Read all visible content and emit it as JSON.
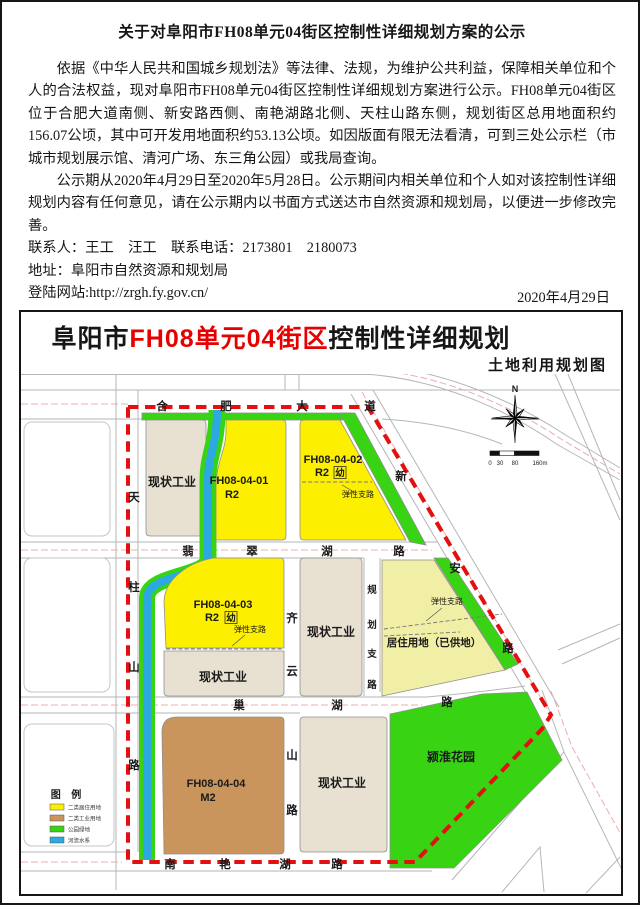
{
  "notice": {
    "title": "关于对阜阳市FH08单元04街区控制性详细规划方案的公示",
    "para1": "依据《中华人民共和国城乡规划法》等法律、法规，为维护公共利益，保障相关单位和个人的合法权益，现对阜阳市FH08单元04街区控制性详细规划方案进行公示。FH08单元04街区位于合肥大道南侧、新安路西侧、南艳湖路北侧、天柱山路东侧，规划街区总用地面积约156.07公顷，其中可开发用地面积约53.13公顷。如因版面有限无法看清，可到三处公示栏（市城市规划展示馆、清河广场、东三角公园）或我局查询。",
    "para2": "公示期从2020年4月29日至2020年5月28日。公示期间内相关单位和个人如对该控制性详细规划内容有任何意见，请在公示期内以书面方式送达市自然资源和规划局，以便进一步修改完善。",
    "contact": "联系人：王工　汪工　联系电话：2173801　2180073",
    "address": "地址：阜阳市自然资源和规划局",
    "website": "登陆网站:http://zrgh.fy.gov.cn/",
    "date": "2020年4月29日"
  },
  "map": {
    "title": {
      "prefix": "阜阳市",
      "highlight": "FH08单元04街区",
      "suffix": "控制性详细规划"
    },
    "subtitle": "土地利用规划图",
    "compass_label": "N",
    "colors": {
      "r2": "#FCEF00",
      "m2": "#C9955C",
      "existing": "#E8E1D2",
      "supplied": "#F1EFA6",
      "green": "#38D413",
      "water": "#2BA9E0",
      "boundary": "#E41010",
      "highlight_red": "#E60000"
    },
    "legend": {
      "title": "图 例",
      "items": [
        {
          "label": "二类居住用地",
          "color": "#FCEF00"
        },
        {
          "label": "二类工业用地",
          "color": "#C9955C"
        },
        {
          "label": "公园绿地",
          "color": "#38D413"
        },
        {
          "label": "河流水系",
          "color": "#2BA9E0"
        }
      ]
    },
    "scale": {
      "segments": [
        {
          "x": 488,
          "w": 9.5,
          "fill": "#111111"
        },
        {
          "x": 497.5,
          "w": 15,
          "fill": "#ffffff"
        },
        {
          "x": 512.5,
          "w": 24.5,
          "fill": "#111111"
        }
      ],
      "labels": [
        {
          "t": "0",
          "x": 488
        },
        {
          "t": "30",
          "x": 498
        },
        {
          "t": "80",
          "x": 513
        },
        {
          "t": "160m",
          "x": 538
        }
      ]
    },
    "labels": [
      {
        "t": "合",
        "x": 160,
        "y": 408,
        "c": "road",
        "n": "road-label-hefei-avenue"
      },
      {
        "t": "肥",
        "x": 224,
        "y": 408,
        "c": "road",
        "n": "road-label-hefei-avenue"
      },
      {
        "t": "大",
        "x": 300,
        "y": 408,
        "c": "road",
        "n": "road-label-hefei-avenue"
      },
      {
        "t": "道",
        "x": 368,
        "y": 408,
        "c": "road",
        "n": "road-label-hefei-avenue"
      },
      {
        "t": "翡",
        "x": 186,
        "y": 553,
        "c": "road",
        "n": "road-label-feicuihu-road"
      },
      {
        "t": "翠",
        "x": 250,
        "y": 553,
        "c": "road",
        "n": "road-label-feicuihu-road"
      },
      {
        "t": "湖",
        "x": 325,
        "y": 553,
        "c": "road",
        "n": "road-label-feicuihu-road"
      },
      {
        "t": "路",
        "x": 397,
        "y": 553,
        "c": "road",
        "n": "road-label-feicuihu-road"
      },
      {
        "t": "巢",
        "x": 237,
        "y": 707,
        "c": "road",
        "n": "road-label-chaohu-road"
      },
      {
        "t": "湖",
        "x": 335,
        "y": 707,
        "c": "road",
        "n": "road-label-chaohu-road"
      },
      {
        "t": "路",
        "x": 445,
        "y": 704,
        "c": "road",
        "n": "road-label-chaohu-road"
      },
      {
        "t": "南",
        "x": 168,
        "y": 866,
        "c": "road",
        "n": "road-label-nanyanhu-road"
      },
      {
        "t": "艳",
        "x": 223,
        "y": 866,
        "c": "road",
        "n": "road-label-nanyanhu-road"
      },
      {
        "t": "湖",
        "x": 283,
        "y": 866,
        "c": "road",
        "n": "road-label-nanyanhu-road"
      },
      {
        "t": "路",
        "x": 335,
        "y": 866,
        "c": "road",
        "n": "road-label-nanyanhu-road"
      },
      {
        "t": "天",
        "x": 132,
        "y": 499,
        "c": "road",
        "n": "road-label-tianzhushan-road"
      },
      {
        "t": "柱",
        "x": 132,
        "y": 589,
        "c": "road",
        "n": "road-label-tianzhushan-road"
      },
      {
        "t": "山",
        "x": 132,
        "y": 669,
        "c": "road",
        "n": "road-label-tianzhushan-road"
      },
      {
        "t": "路",
        "x": 132,
        "y": 767,
        "c": "road",
        "n": "road-label-tianzhushan-road"
      },
      {
        "t": "齐",
        "x": 290,
        "y": 620,
        "c": "road",
        "n": "road-label-qiyunshan-road"
      },
      {
        "t": "云",
        "x": 290,
        "y": 673,
        "c": "road",
        "n": "road-label-qiyunshan-road"
      },
      {
        "t": "山",
        "x": 290,
        "y": 757,
        "c": "road",
        "n": "road-label-qiyunshan-road"
      },
      {
        "t": "路",
        "x": 290,
        "y": 812,
        "c": "road",
        "n": "road-label-qiyunshan-road"
      },
      {
        "t": "规",
        "x": 370,
        "y": 591,
        "c": "roadsm",
        "n": "road-label-planned-branch-road"
      },
      {
        "t": "划",
        "x": 370,
        "y": 626,
        "c": "roadsm",
        "n": "road-label-planned-branch-road"
      },
      {
        "t": "支",
        "x": 370,
        "y": 655,
        "c": "roadsm",
        "n": "road-label-planned-branch-road"
      },
      {
        "t": "路",
        "x": 370,
        "y": 686,
        "c": "roadsm",
        "n": "road-label-planned-branch-road"
      },
      {
        "t": "新",
        "x": 399,
        "y": 478,
        "c": "road",
        "n": "road-label-xinan-road"
      },
      {
        "t": "安",
        "x": 453,
        "y": 570,
        "c": "road",
        "n": "road-label-xinan-road"
      },
      {
        "t": "路",
        "x": 506,
        "y": 650,
        "c": "road",
        "n": "road-label-xinan-road"
      },
      {
        "t": "FH08-04-01",
        "x": 237,
        "y": 482,
        "c": "pcode",
        "n": "parcel-code-fh08-04-01"
      },
      {
        "t": "R2",
        "x": 230,
        "y": 496,
        "c": "pcode",
        "n": "parcel-use-fh08-04-01"
      },
      {
        "t": "FH08-04-02",
        "x": 331,
        "y": 461,
        "c": "pcode",
        "n": "parcel-code-fh08-04-02"
      },
      {
        "t": "R2",
        "x": 320,
        "y": 474,
        "c": "pcode",
        "n": "parcel-use-fh08-04-02"
      },
      {
        "t": "幼",
        "x": 338,
        "y": 474,
        "c": "ptag",
        "box": true,
        "n": "kindergarten-tag"
      },
      {
        "t": "FH08-04-03",
        "x": 221,
        "y": 606,
        "c": "pcode",
        "n": "parcel-code-fh08-04-03"
      },
      {
        "t": "R2",
        "x": 210,
        "y": 619,
        "c": "pcode",
        "n": "parcel-use-fh08-04-03"
      },
      {
        "t": "幼",
        "x": 229,
        "y": 619,
        "c": "ptag",
        "box": true,
        "n": "kindergarten-tag"
      },
      {
        "t": "FH08-04-04",
        "x": 214,
        "y": 785,
        "c": "pcode",
        "n": "parcel-code-fh08-04-04"
      },
      {
        "t": "M2",
        "x": 206,
        "y": 799,
        "c": "pcode",
        "n": "parcel-use-fh08-04-04"
      },
      {
        "t": "现状工业",
        "x": 170,
        "y": 484,
        "c": "puse",
        "n": "label-existing-industry"
      },
      {
        "t": "现状工业",
        "x": 221,
        "y": 679,
        "c": "puse",
        "n": "label-existing-industry"
      },
      {
        "t": "现状工业",
        "x": 329,
        "y": 634,
        "c": "puse",
        "n": "label-existing-industry"
      },
      {
        "t": "现状工业",
        "x": 340,
        "y": 785,
        "c": "puse",
        "n": "label-existing-industry"
      },
      {
        "t": "居住用地（已供地）",
        "x": 432,
        "y": 644,
        "c": "puse2",
        "n": "label-residential-supplied"
      },
      {
        "t": "颍淮花园",
        "x": 449,
        "y": 759,
        "c": "puse",
        "n": "label-yinghuai-garden"
      },
      {
        "t": "弹性支路",
        "x": 356,
        "y": 495,
        "c": "small",
        "n": "label-elastic-branch-road"
      },
      {
        "t": "弹性支路",
        "x": 248,
        "y": 630,
        "c": "small",
        "n": "label-elastic-branch-road"
      },
      {
        "t": "弹性支路",
        "x": 445,
        "y": 602,
        "c": "small",
        "n": "label-elastic-branch-road"
      }
    ]
  }
}
